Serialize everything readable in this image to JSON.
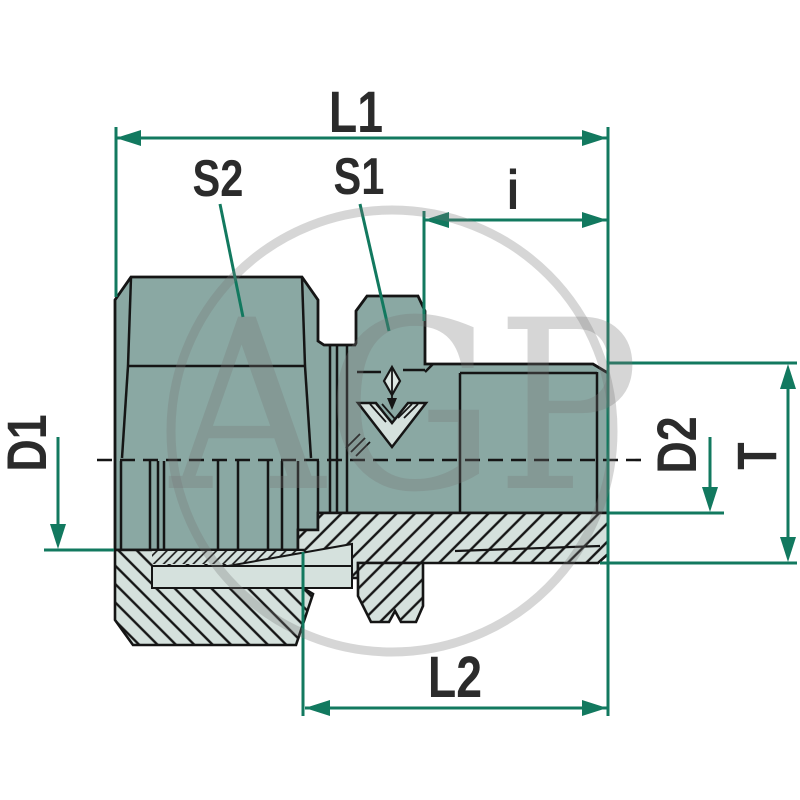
{
  "drawing": {
    "type": "technical-drawing",
    "subject": "straight male stud compression fitting, half-section view",
    "labels": {
      "L1": "L1",
      "S2": "S2",
      "S1": "S1",
      "i": "i",
      "D1": "D1",
      "D2": "D2",
      "T": "T",
      "L2": "L2"
    },
    "watermark": {
      "text": "AGP"
    },
    "colors": {
      "body_fill": "#8aa8a3",
      "section_fill": "#d5e1dd",
      "outline": "#151515",
      "dimension_green": "#12795f",
      "label_text": "#2b2b2b",
      "watermark_gray": "#787878",
      "background": "#ffffff"
    }
  }
}
